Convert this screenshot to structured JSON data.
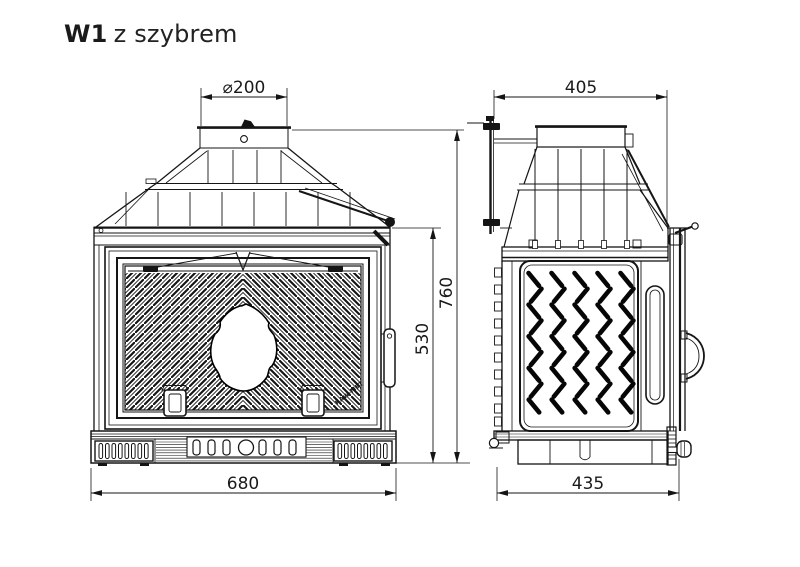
{
  "title": {
    "model": "W1",
    "suffix": "z szybrem"
  },
  "dimensions": {
    "flue_diameter": "⌀200",
    "overall_height": "760",
    "firebox_height": "530",
    "front_width": "680",
    "top_depth": "405",
    "base_depth": "435"
  },
  "branding": {
    "glass_stamp": "KAW-MET"
  }
}
